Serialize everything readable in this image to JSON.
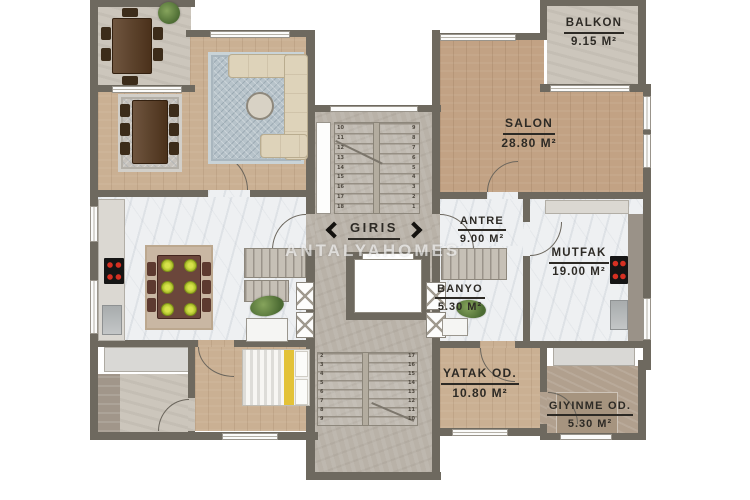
{
  "watermark": "ANTALYAHOMES",
  "entrance": {
    "label": "GIRIS"
  },
  "rooms": {
    "balkon": {
      "name": "BALKON",
      "area": "9.15 m²"
    },
    "salon": {
      "name": "SALON",
      "area": "28.80 m²"
    },
    "antre": {
      "name": "ANTRE",
      "area": "9.00 m²"
    },
    "mutfak": {
      "name": "MUTFAK",
      "area": "19.00 m²"
    },
    "banyo": {
      "name": "BANYO",
      "area": "5.30 m²"
    },
    "yatak": {
      "name": "YATAK OD.",
      "area": "10.80 m²"
    },
    "giyinme": {
      "name": "GIYINME OD.",
      "area": "5.30 m²"
    }
  },
  "stairs": {
    "upper_flight_left_numbers": [
      "10",
      "11",
      "12",
      "13",
      "14",
      "15",
      "16",
      "17",
      "18"
    ],
    "upper_flight_right_numbers": [
      "9",
      "8",
      "7",
      "6",
      "5",
      "4",
      "3",
      "2",
      "1"
    ],
    "lower_flight_left_numbers": [
      "2",
      "3",
      "4",
      "5",
      "6",
      "7",
      "8",
      "9"
    ],
    "lower_flight_right_numbers": [
      "17",
      "16",
      "15",
      "14",
      "13",
      "12",
      "11",
      "10"
    ]
  },
  "colors": {
    "wall": "#6e695f",
    "wood_floor": "#cab093",
    "wood_floor_salon": "#c2a284",
    "stone_floor": "#ccc6bc",
    "marble_floor": "#eef0f2",
    "stairwell_floor": "#b9b2a8",
    "stove_burner": "#d63022",
    "label_text": "#2d2a25"
  }
}
